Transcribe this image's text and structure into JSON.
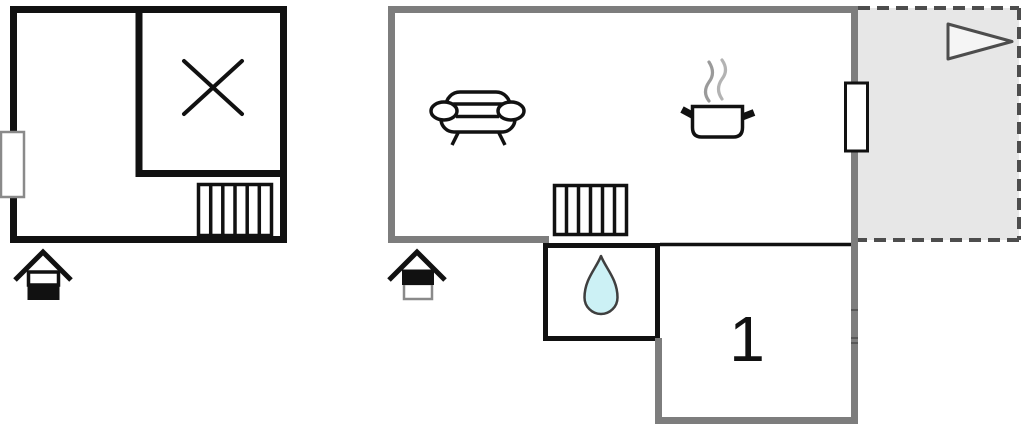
{
  "colors": {
    "wall_black": "#111111",
    "wall_gray": "#7d7d7d",
    "terrace_fill": "#e7e7e7",
    "dash_gray": "#4d4d4d",
    "drop_fill": "#ccf1f5",
    "drop_stroke": "#3f3f3f",
    "steam_gray": "#9a9a9a",
    "steam_gray_light": "#b3b3b3",
    "flag_fill": "#f5f5f5",
    "window_border_gray": "#8a8a8a",
    "background": "#ffffff"
  },
  "labels": {
    "bedroom_number": "1"
  },
  "floor_plan": {
    "type": "vacation-house-floor-plan",
    "buildings": [
      {
        "id": "annex",
        "wall_color": "black",
        "floor_indicator": "ground-floor (house icon, lower half filled)",
        "icons": [
          "cross-mark-icon",
          "radiator-icon",
          "window",
          "house-floor-icon"
        ]
      },
      {
        "id": "main-house",
        "wall_color": "gray",
        "floor_indicator": "upper-floor (house icon, upper half filled)",
        "icons": [
          "sofa-icon",
          "cooking-pot-icon",
          "steam-icon",
          "radiator-icon",
          "window",
          "water-drop-icon",
          "pennant-arrow-icon",
          "house-floor-icon"
        ],
        "areas": [
          "living-kitchen-room",
          "bathroom",
          "bedroom-1",
          "terrace-dashed"
        ],
        "rooms": [
          {
            "label": "1",
            "type": "bedroom"
          }
        ]
      }
    ]
  }
}
